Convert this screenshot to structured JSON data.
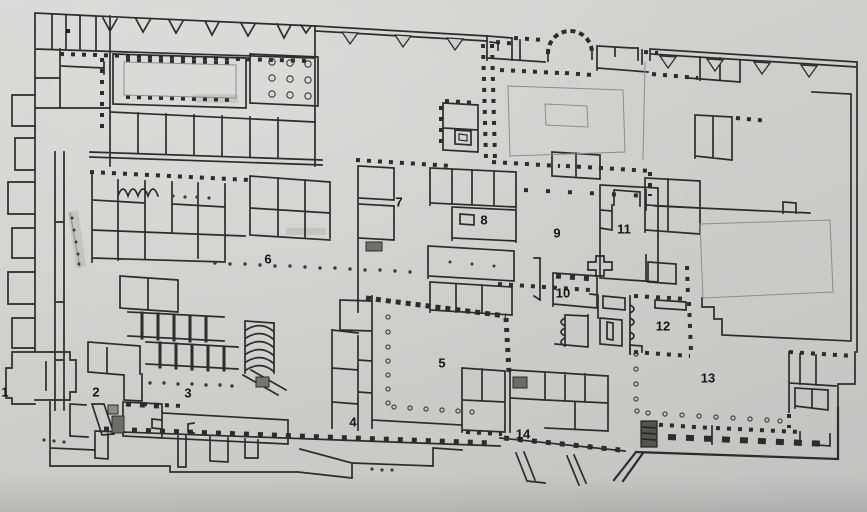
{
  "figure": {
    "kind": "archaeological floor plan photograph",
    "visible_text_note": "only numeric area labels are printed on the plan",
    "colors": {
      "paper": "#cfcfcc",
      "wall": "#2c2c2c",
      "light_line": "#8d8d8b"
    },
    "labels": [
      {
        "text": "1",
        "x": 5,
        "y": 392
      },
      {
        "text": "2",
        "x": 96,
        "y": 392
      },
      {
        "text": "3",
        "x": 188,
        "y": 393
      },
      {
        "text": "4",
        "x": 353,
        "y": 422
      },
      {
        "text": "5",
        "x": 442,
        "y": 363
      },
      {
        "text": "6",
        "x": 268,
        "y": 259
      },
      {
        "text": "7",
        "x": 399,
        "y": 202
      },
      {
        "text": "8",
        "x": 484,
        "y": 220
      },
      {
        "text": "9",
        "x": 557,
        "y": 233
      },
      {
        "text": "10",
        "x": 563,
        "y": 293
      },
      {
        "text": "11",
        "x": 624,
        "y": 229
      },
      {
        "text": "12",
        "x": 663,
        "y": 326
      },
      {
        "text": "13",
        "x": 708,
        "y": 378
      },
      {
        "text": "14",
        "x": 523,
        "y": 434
      }
    ]
  }
}
